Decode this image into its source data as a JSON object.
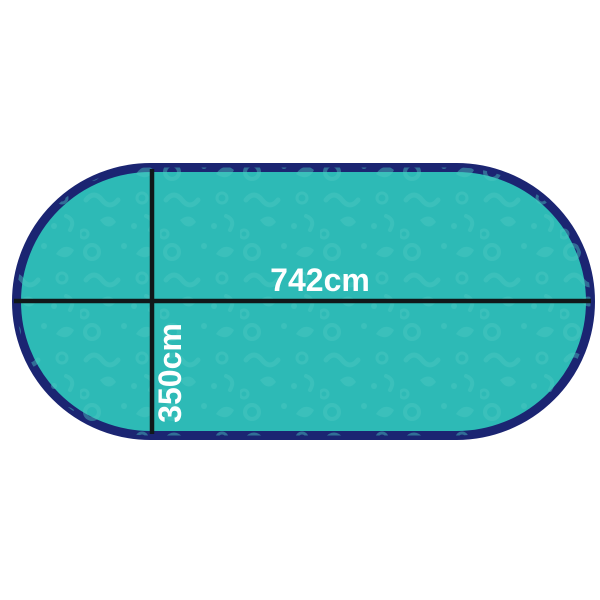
{
  "diagram": {
    "width_label": "742cm",
    "height_label": "350cm",
    "colors": {
      "background": "#ffffff",
      "cover_fill": "#2dbab6",
      "texture_motif": "#4cc7c2",
      "border": "#1b2572",
      "dimension_line": "#10181a",
      "label_text": "#ffffff"
    }
  }
}
